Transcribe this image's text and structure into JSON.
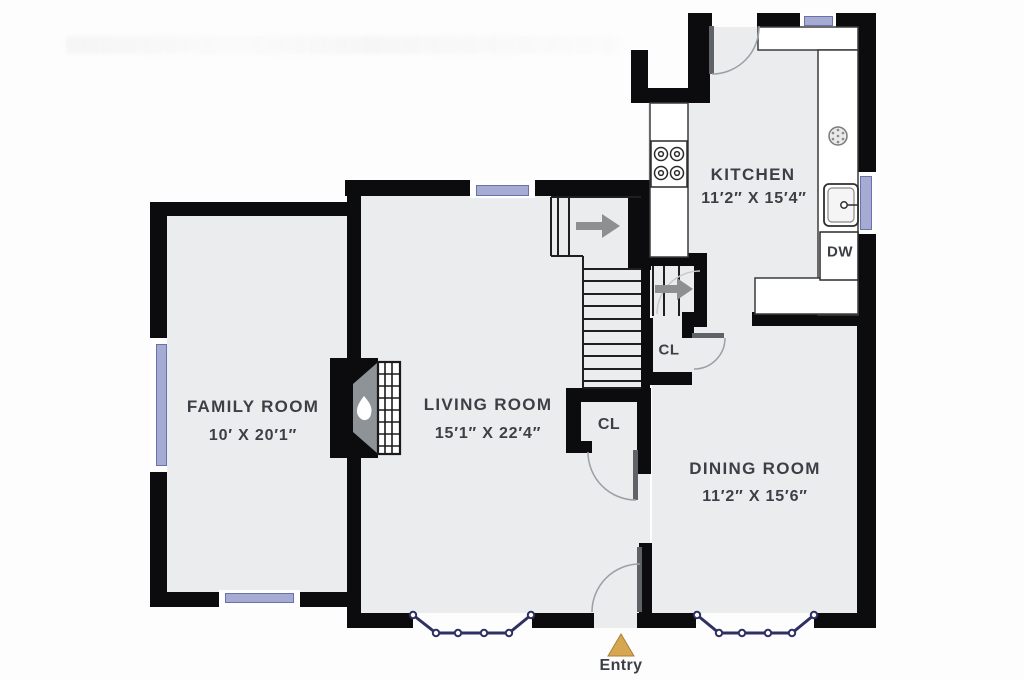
{
  "plan": {
    "rooms": [
      {
        "name": "FAMILY ROOM",
        "dims": "10′ X 20′1″"
      },
      {
        "name": "LIVING ROOM",
        "dims": "15′1″ X 22′4″"
      },
      {
        "name": "KITCHEN",
        "dims": "11′2″ X 15′4″"
      },
      {
        "name": "DINING ROOM",
        "dims": "11′2″ X 15′6″"
      }
    ],
    "closets": [
      {
        "label": "CL"
      },
      {
        "label": "CL"
      }
    ],
    "labels": {
      "dishwasher": "DW",
      "entry": "Entry"
    }
  },
  "colors": {
    "wall": "#0c0c0e",
    "floor": "#ebecee",
    "window": "#a6abd3",
    "window_frame": "#6a72aa",
    "bay": "#2e3063",
    "entry_accent": "#d7a650",
    "door": "#5f6368",
    "arrow": "#8f8f8f",
    "line": "#1f1f1f",
    "label": "#3c3f45"
  }
}
